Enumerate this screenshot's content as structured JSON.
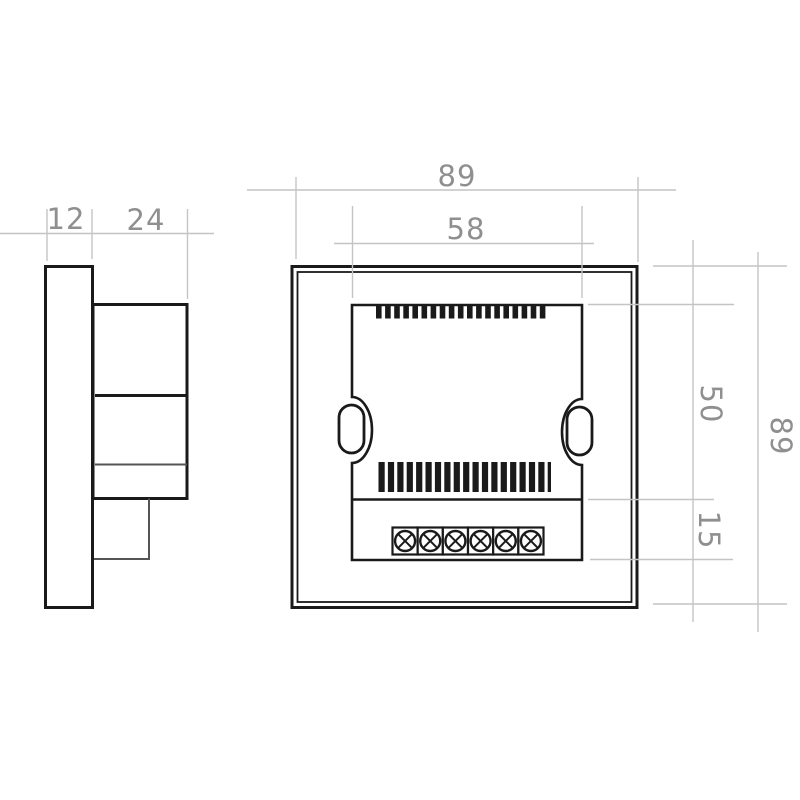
{
  "views": {
    "side": {
      "dimensions": {
        "front_plate_thickness": "12",
        "body_depth": "24"
      }
    },
    "back": {
      "dimensions": {
        "overall_width": "89",
        "inner_panel_width": "58",
        "upper_section_height": "50",
        "terminal_section_height": "15",
        "overall_height": "89"
      },
      "terminal_screw_count": 6,
      "top_vent_slot_count": 19,
      "bottom_vent_slot_count": 19
    }
  },
  "colors": {
    "outline": "#1a1a1a",
    "secondary_line": "#555555",
    "dimension_line": "#c4c4c4",
    "dimension_text": "#8f8f8f",
    "background": "#ffffff"
  }
}
